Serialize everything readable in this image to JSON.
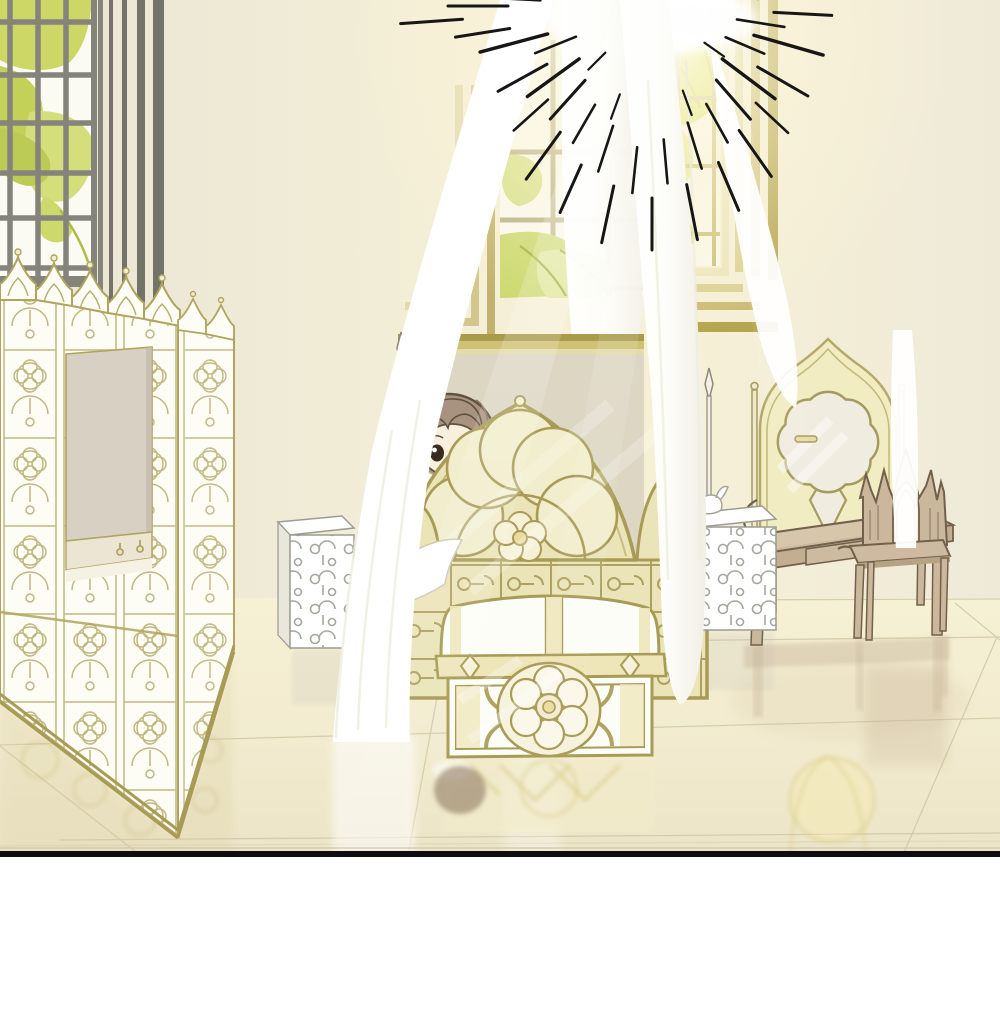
{
  "scene": {
    "title": "webtoon-bedroom-panel",
    "style": "pastel manhwa interior, morning light",
    "objects": [
      "left-lattice-window",
      "window-foliage",
      "wall-pilaster-stripes",
      "center-arched-window",
      "right-arched-window",
      "sun-glow",
      "sunburst-rays",
      "canopy-curtain-left",
      "canopy-curtain-back",
      "canopy-curtain-right",
      "canopy-curtain-strand",
      "folding-screen",
      "screen-pass-through-opening",
      "bed-footboard",
      "bed-flower-medallion",
      "bedpost-left",
      "bedpost-right",
      "child-character",
      "bedding",
      "storage-chest",
      "chest-flower-medallion",
      "nightstand-left",
      "nightstand-right",
      "scroll-ornament",
      "vanity-table",
      "vanity-mirror",
      "mirror-rosette",
      "vanity-chair",
      "chair-gothic-crown",
      "glossy-floor",
      "tile-lines",
      "floor-reflections",
      "panel-border-line",
      "page-margin"
    ]
  },
  "palette": {
    "wall_left": "#e9e5d5",
    "wall_mid": "#f6f0d6",
    "wall_right": "#f0ebd9",
    "glow_core": "#fffef6",
    "glow_warm": "#faf2cf",
    "curtain": "#ffffff",
    "curtain_shade": "#ededdf",
    "gold_line": "#a89b55",
    "gold_soft": "#c9bd7e",
    "bed_fill": "#ebe4b9",
    "bed_light": "#f3eecd",
    "foliage_bright": "#dde14e",
    "foliage_mid": "#ccd96e",
    "foliage_soft": "#e0e894",
    "foliage_dark": "#aebd45",
    "mullion": "#84847b",
    "frame_stripe": "#6f6f66",
    "backdrop": "#ddd6c3",
    "band_dark": "#a89b4b",
    "band_gold": "#cfc176",
    "wood": "#cbb79b",
    "wood_dark": "#b19c80",
    "wood_line": "#71604b",
    "floor_top": "#f6f0d5",
    "floor_bottom": "#ece4c7",
    "tile_line": "#cfc6a5",
    "mirror_frame": "#f2ecc2",
    "mirror_glass": "#f1ece0",
    "screen_white": "#fdfdf6",
    "screen_line": "#b0a45e",
    "opening": "#d8d0c3",
    "sill": "#ece5d3",
    "lattice_gray": "#9d9d94",
    "hair": "#a7937f",
    "hair_line": "#60513f",
    "skin": "#f8efdd",
    "eye": "#382c22",
    "chest_trim": "#eee5b9",
    "ray": "#161616",
    "border": "#0e0e0e",
    "page": "#ffffff"
  }
}
